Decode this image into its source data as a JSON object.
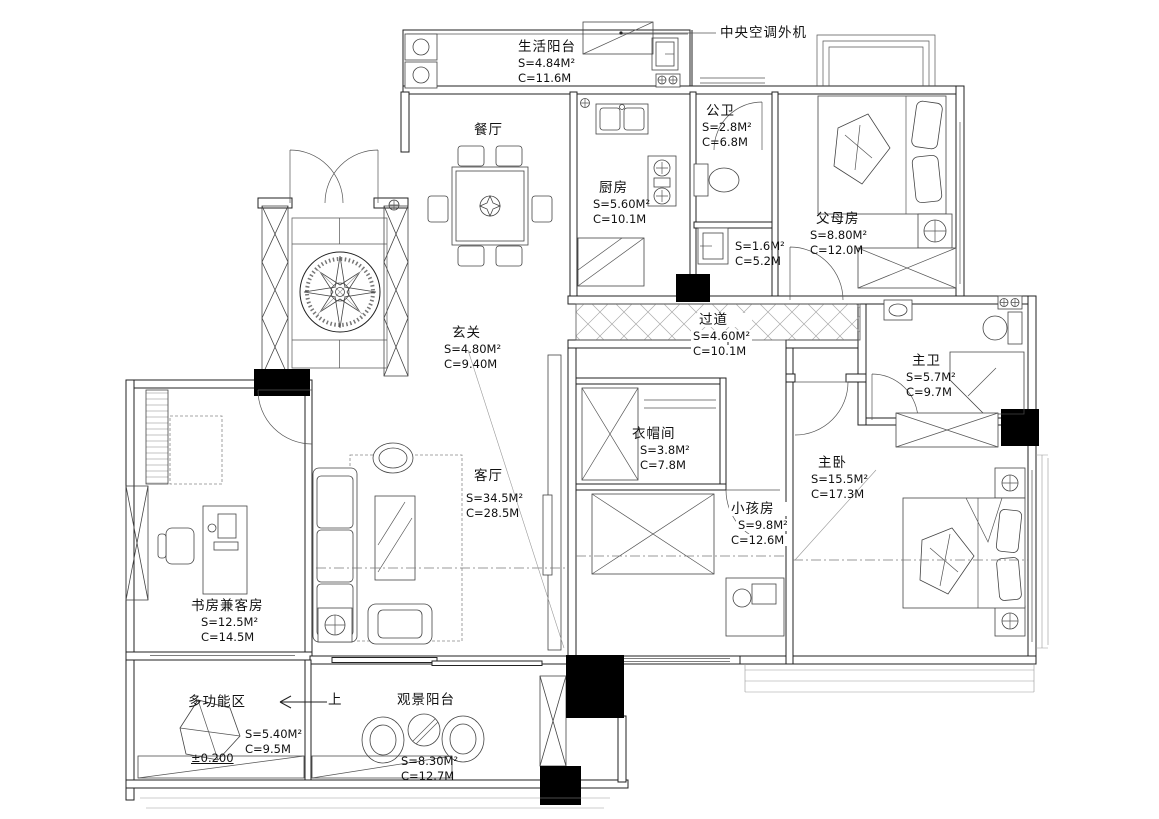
{
  "annotations": {
    "ac_unit": "中央空调外机",
    "up": "上",
    "level": "±0.200"
  },
  "rooms": {
    "life_balcony": {
      "name": "生活阳台",
      "s": "S=4.84M²",
      "c": "C=11.6M"
    },
    "public_bath": {
      "name": "公卫",
      "s": "S=2.8M²",
      "c": "C=6.8M"
    },
    "kitchen": {
      "name": "厨房",
      "s": "S=5.60M²",
      "c": "C=10.1M"
    },
    "parents_room": {
      "name": "父母房",
      "s": "S=8.80M²",
      "c": "C=12.0M"
    },
    "small_room": {
      "s": "S=1.6M²",
      "c": "C=5.2M"
    },
    "dining": {
      "name": "餐厅"
    },
    "entry_hall": {
      "name": "玄关",
      "s": "S=4.80M²",
      "c": "C=9.40M"
    },
    "corridor": {
      "name": "过道",
      "s": "S=4.60M²",
      "c": "C=10.1M"
    },
    "master_bath": {
      "name": "主卫",
      "s": "S=5.7M²",
      "c": "C=9.7M"
    },
    "closet": {
      "name": "衣帽间",
      "s": "S=3.8M²",
      "c": "C=7.8M"
    },
    "living": {
      "name": "客厅",
      "s": "S=34.5M²",
      "c": "C=28.5M"
    },
    "kids_room": {
      "name": "小孩房",
      "s": "S=9.8M²",
      "c": "C=12.6M"
    },
    "master_bed": {
      "name": "主卧",
      "s": "S=15.5M²",
      "c": "C=17.3M"
    },
    "study": {
      "name": "书房兼客房",
      "s": "S=12.5M²",
      "c": "C=14.5M"
    },
    "multi_zone": {
      "name": "多功能区",
      "s": "S=5.40M²",
      "c": "C=9.5M"
    },
    "view_balcony": {
      "name": "观景阳台",
      "s": "S=8.30M²",
      "c": "C=12.7M"
    }
  }
}
